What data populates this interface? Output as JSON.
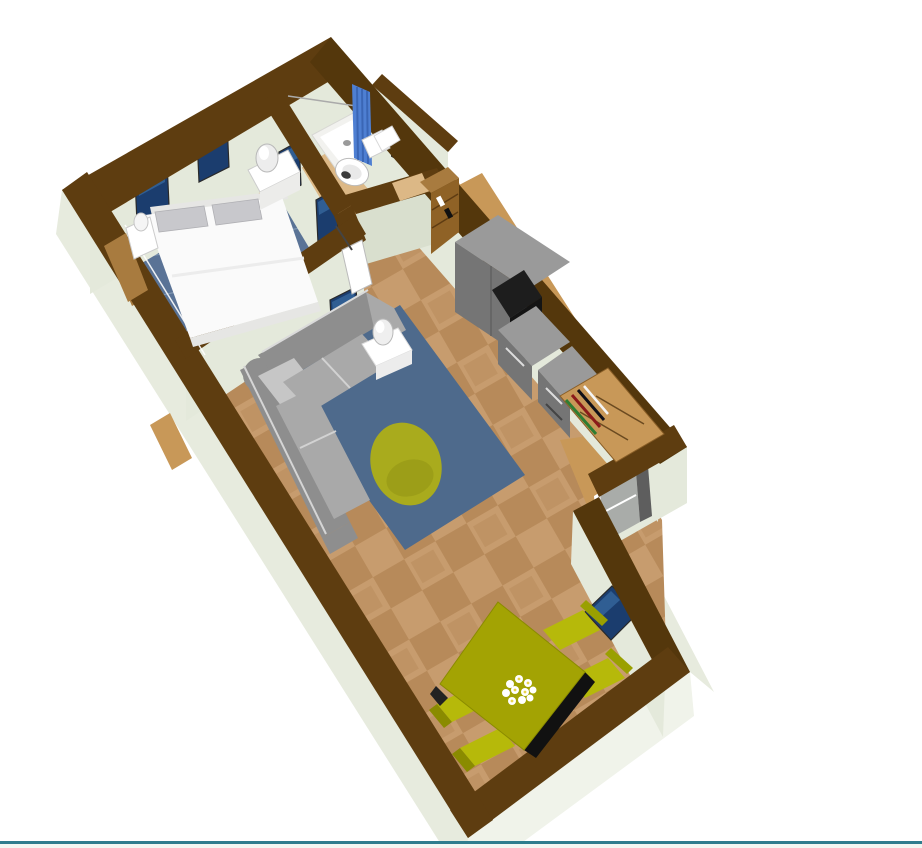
{
  "app": {
    "type": "home-design-3d-viewport",
    "view": "aerial 3d rendering of a studio apartment floor plan, rotated diagonally on white background"
  },
  "colors": {
    "background": "#ffffff",
    "wall_top": "#5E3D10",
    "wall_top_dark": "#54370C",
    "ext_face": "#E7EBDE",
    "ext_face_bright": "#F0F3EA",
    "int_face": "#E4E9DB",
    "int_face_shaded": "#D9DFCE",
    "wood_floor": "#DCB886",
    "wood_mid": "#C89858",
    "wood_dark": "#A87B3F",
    "tile_a": "#C79C6E",
    "tile_b": "#B78A5A",
    "rug_bedroom": "#5A7396",
    "rug_living": "#4E6A8C",
    "rug_grid": "#9FB2C8",
    "bed_white": "#FAFAFA",
    "bed_shadow": "#E6E6E4",
    "pillow": "#C8C8CC",
    "sofa_dark": "#8E8E8E",
    "sofa_mid": "#A9A9A9",
    "sofa_light": "#C6C6C6",
    "beanbag": "#A9AB1D",
    "olive_top": "#A3A303",
    "olive_side": "#8A8B00",
    "olive_chair": "#B6B90A",
    "kitchen_top": "#9A9A9A",
    "kitchen_front": "#757575",
    "kitchen_dark": "#5E5E5E",
    "appliance_black": "#141414",
    "curtain_blue": "#4E7FD2",
    "curtain_blue_dark": "#3A66B5",
    "window_navy_mid": "#1B3D6E",
    "window_navy_light": "#3C70A8",
    "window_navy_dark": "#0A1C38",
    "mirror_gray": "#9FA4A8",
    "frame_dark": "#2A2A2A",
    "white": "#FFFFFF",
    "door_gray": "#A9ACA9",
    "divider_teal": "#2E7D8E",
    "statusbar_bg": "#F2F7F2"
  },
  "scene": {
    "rooms": [
      "bedroom",
      "bathroom",
      "hallway",
      "kitchen",
      "living-room",
      "dining-area",
      "entry-alcove"
    ],
    "furniture": [
      "double-bed",
      "pillows",
      "nightstand-left",
      "nightstand-right",
      "bedside-lamp",
      "wall-windows-navy",
      "shower-tray",
      "shower-curtain",
      "toilet",
      "bathroom-sink",
      "bathroom-mirror",
      "sectional-sofa",
      "side-table",
      "table-lamp",
      "living-rug",
      "beanbag-pouf",
      "tall-cabinet",
      "kitchen-counters",
      "black-appliance",
      "bookshelf-top",
      "bookshelf-end",
      "dining-table",
      "dining-chairs",
      "flower-centerpiece",
      "entry-door",
      "wall-picture-dining"
    ]
  }
}
